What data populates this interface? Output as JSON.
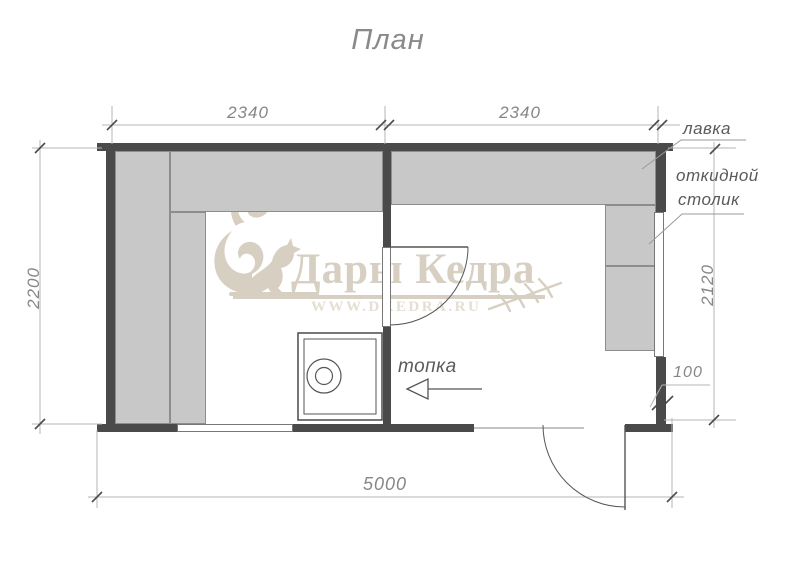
{
  "title": "План",
  "dimensions": {
    "top_left": "2340",
    "top_right": "2340",
    "left": "2200",
    "right": "2120",
    "wall_offset": "100",
    "bottom": "5000"
  },
  "labels": {
    "bench": "лавка",
    "folding_table_line1": "откидной",
    "folding_table_line2": "столик",
    "furnace": "топка"
  },
  "watermark": {
    "brand": "Дары Кедра",
    "url": "WWW.DKEDRA.RU"
  },
  "colors": {
    "wall": "#4a4a4a",
    "bench_fill": "#c8c8c8",
    "bench_border": "#8d8d8d",
    "dim_line": "#b5b5b5",
    "tick": "#4a4a4a",
    "dim_text": "#868686",
    "label_text": "#5a5a5a",
    "drawing_line": "#555555",
    "watermark": "#d7cfc2",
    "watermark_url": "#e4ded4"
  }
}
